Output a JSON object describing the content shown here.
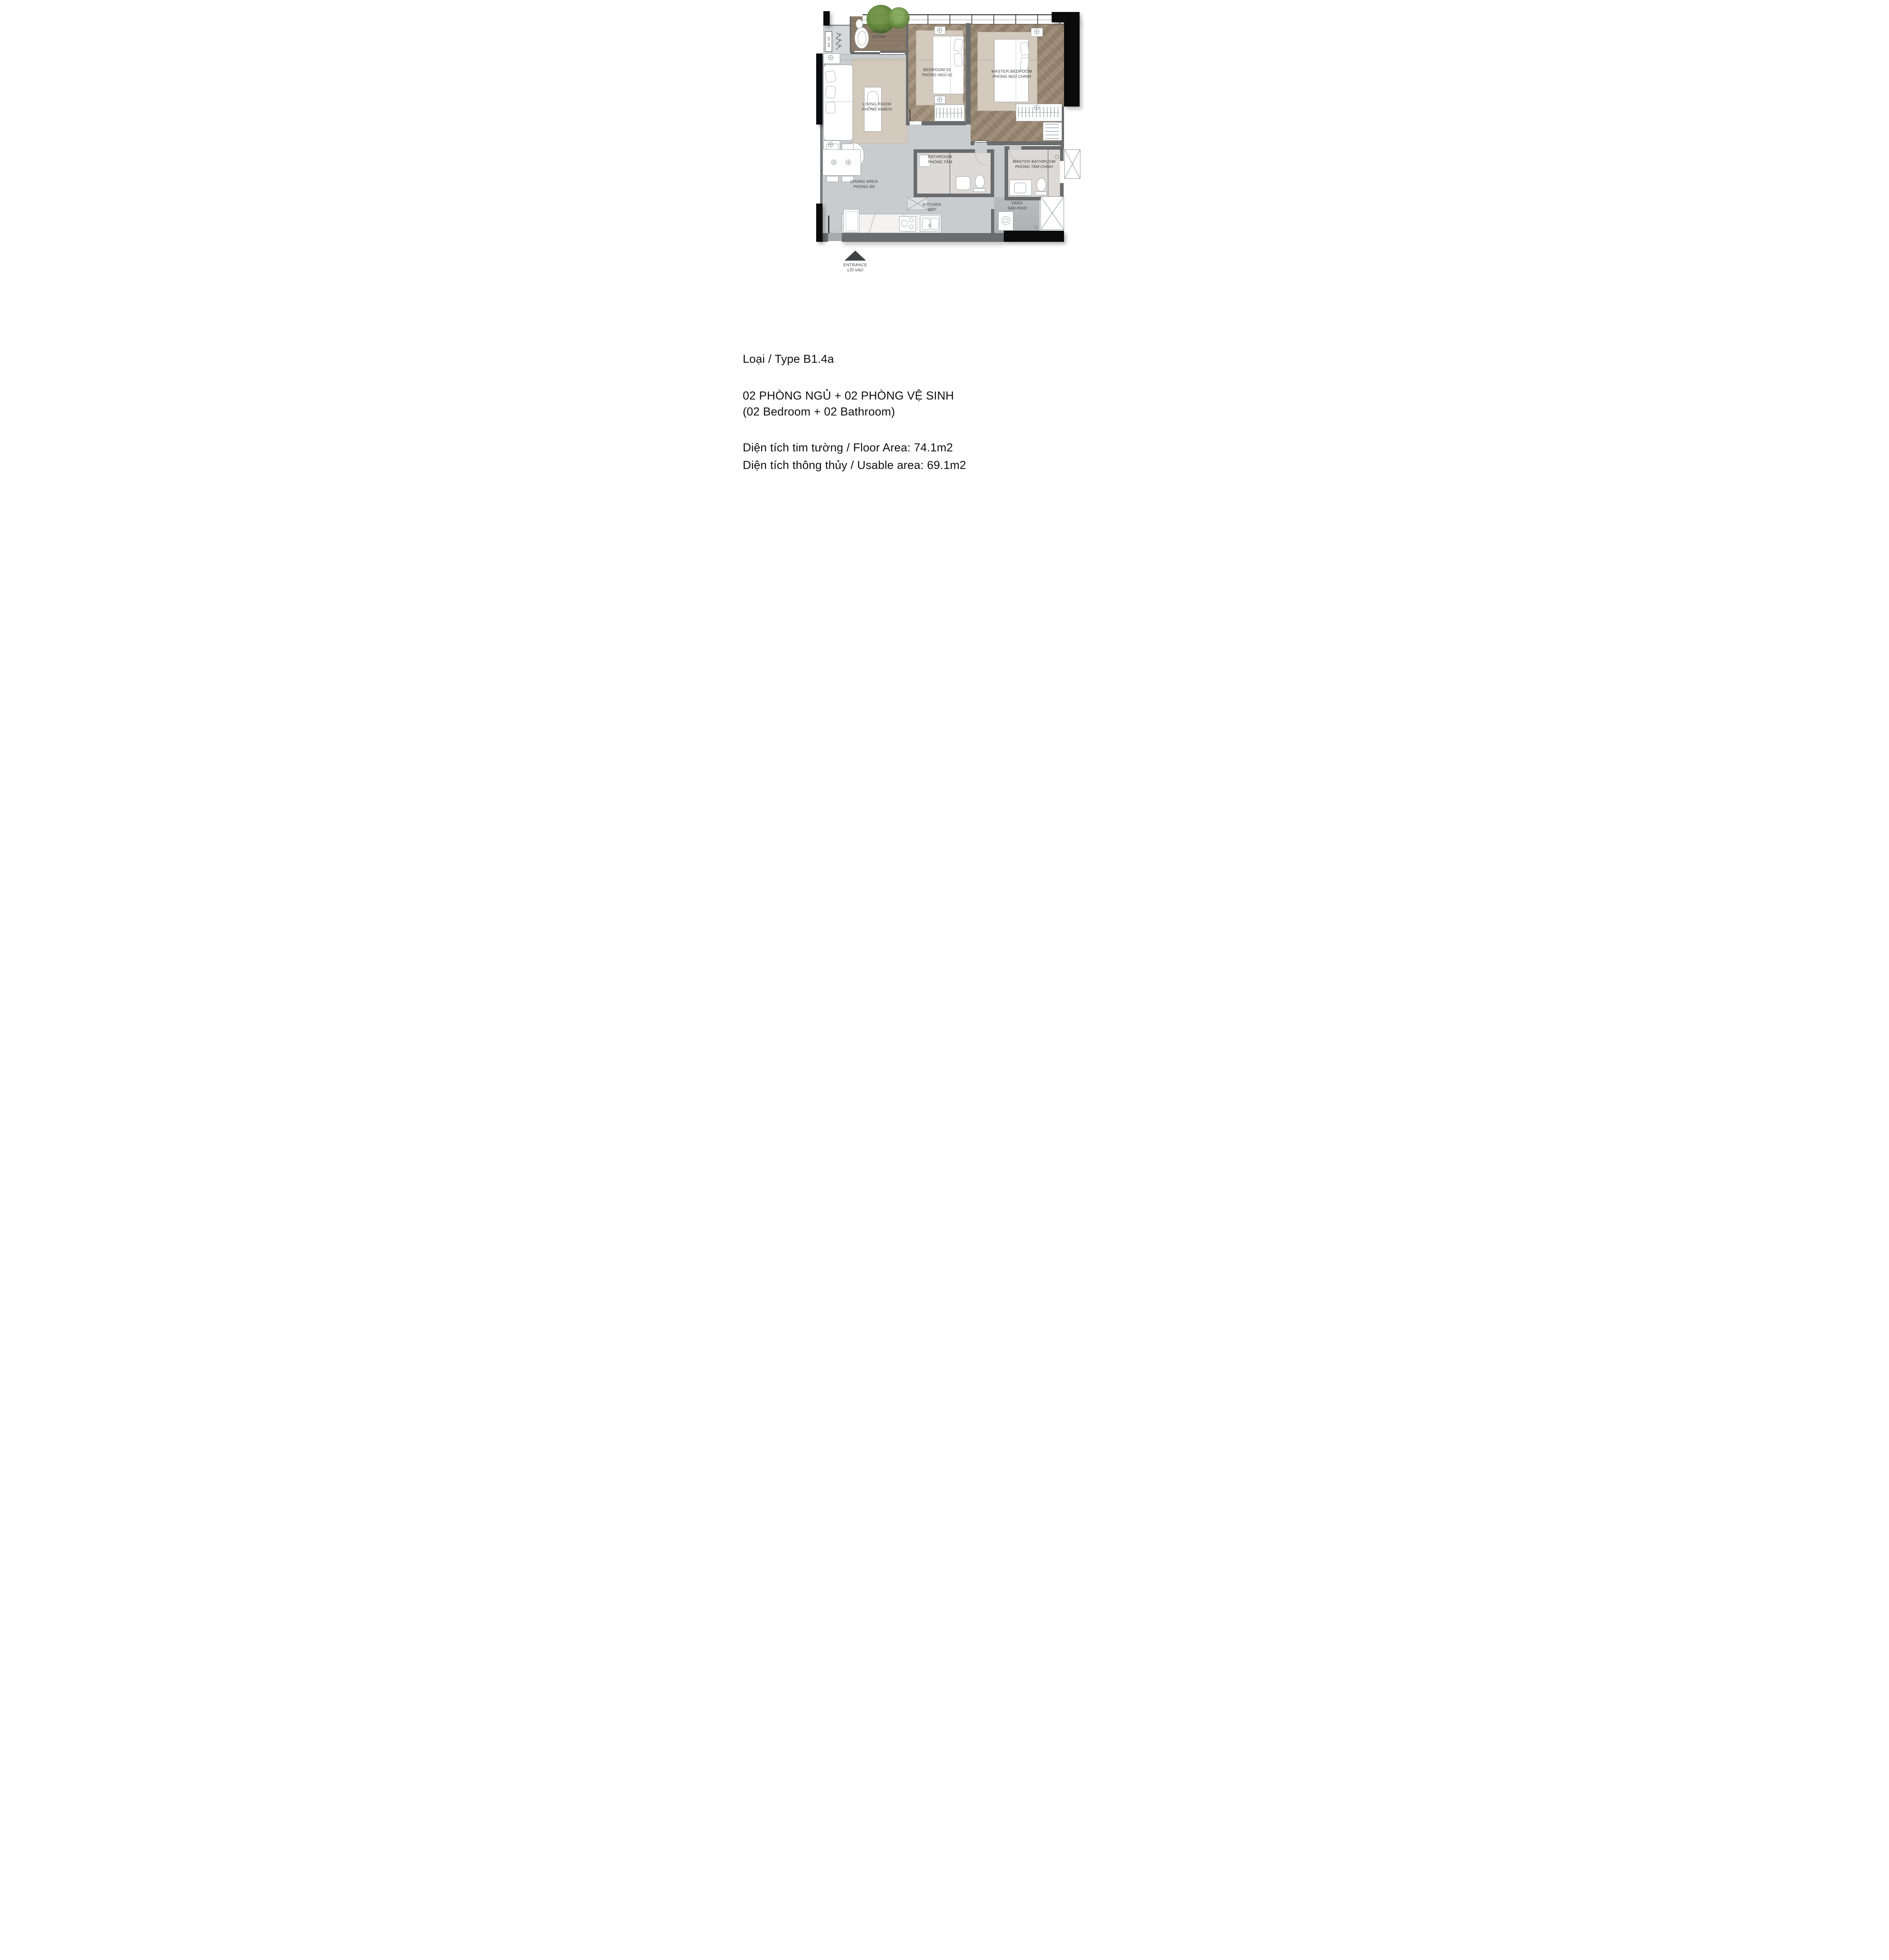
{
  "plan": {
    "rooms": [
      {
        "id": "loggia",
        "en": "LOGGIA",
        "vi": "LÔ GIA"
      },
      {
        "id": "bedroom-02",
        "en": "BEDROOM 02",
        "vi": "PHÒNG NGỦ 02"
      },
      {
        "id": "master-bedroom",
        "en": "MASTER BEDROOM",
        "vi": "PHÒNG NGỦ CHÍNH"
      },
      {
        "id": "living-room",
        "en": "LIVING ROOM",
        "vi": "PHÒNG KHÁCH"
      },
      {
        "id": "dining-area",
        "en": "DINING AREA",
        "vi": "PHÒNG ĂN"
      },
      {
        "id": "bathroom",
        "en": "BATHROOM",
        "vi": "PHÒNG TẮM"
      },
      {
        "id": "master-bathroom",
        "en": "MASTER BATHROOM",
        "vi": "PHÒNG TẮM CHÍNH"
      },
      {
        "id": "kitchen",
        "en": "KITCHEN",
        "vi": "BẾP"
      },
      {
        "id": "yard",
        "en": "YARD",
        "vi": "SÂN PHƠI"
      }
    ],
    "entrance": {
      "en": "ENTRANCE",
      "vi": "LỐI VÀO"
    },
    "ac_label": "AC X2",
    "icons": {
      "entrance_arrow": "triangle-up",
      "lamp": "circle-cross",
      "fan": "vent-circle",
      "plant": "foliage-blob",
      "washing_machine": "drum-circle"
    }
  },
  "info": {
    "type_line": "Loại / Type B1.4a",
    "config_line1": "02 PHÒNG NGỦ + 02 PHÒNG VỆ SINH",
    "config_line2": "(02 Bedroom + 02 Bathroom)",
    "floor_area_line": "Diện tích tim tường / Floor Area: 74.1m2",
    "usable_area_line": "Diện tích thông thủy / Usable area: 69.1m2"
  },
  "colors": {
    "wall_gray": "#6a6c6e",
    "structure_black": "#0b0b0c",
    "floor_gray": "#c9cccf",
    "wood_herringbone": "#9a8974",
    "loggia_wood": "#88765f",
    "bath_marble": "#dcd9d6",
    "rug_beige": "#d3c9bd",
    "yard_tile": "#b5b7b9",
    "label_text": "#3d3e40",
    "plant_green": "#5d8038"
  }
}
